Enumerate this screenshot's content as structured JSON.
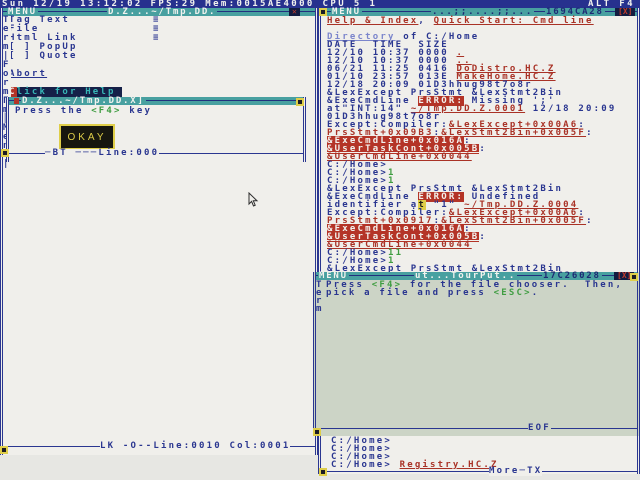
{
  "topbar": {
    "status": "Sun 12/19 13:12:02 FPS:29 Mem:0015AE4000 CPU 5 1",
    "hotkey": "ALT F4"
  },
  "icons": {
    "close_x": "✕",
    "close_box": "[X]",
    "submenu": "≡",
    "red_square": "",
    "resize_handle": ""
  },
  "left_window": {
    "titlebar": {
      "menu_label": "MENU",
      "doc_title": "D.Z...~/Tmp.DD."
    },
    "border_chars": [
      "T",
      "e",
      "r",
      "m",
      "|",
      "F",
      "o",
      "r",
      "m",
      "Г",
      "m",
      "║",
      "M",
      "e",
      "n",
      "u",
      "|"
    ],
    "menu_items": [
      {
        "label": "Tag Text",
        "kind": "submenu"
      },
      {
        "label": "File",
        "kind": "submenu"
      },
      {
        "label": "Html Link",
        "kind": "submenu"
      },
      {
        "label": "[ ] PopUp",
        "kind": "plain"
      },
      {
        "label": "[ ] Quote",
        "kind": "plain"
      },
      {
        "label": "",
        "kind": "blank"
      },
      {
        "label": "Abort",
        "kind": "link"
      },
      {
        "label": "",
        "kind": "blank"
      },
      {
        "label": "Click for Help",
        "kind": "highlight",
        "hotkey": "C"
      }
    ],
    "form_popup": {
      "title": "D.Z...~/Tmp.DD.X]",
      "body": [
        [
          [
            "n",
            "Press the "
          ],
          [
            "g",
            "<F4>"
          ],
          [
            "n",
            " key"
          ]
        ]
      ],
      "button_label": "OKAY",
      "status": "─BT ───Line:000"
    },
    "status": "LK -O--Line:0010 Col:0001"
  },
  "right_window": {
    "titlebar": {
      "menu_label": "MENU",
      "doc_title": "...;;....;;...",
      "address": "1694CA28"
    },
    "lines": [
      [
        [
          "l",
          "Help & Index"
        ],
        [
          "n",
          ", "
        ],
        [
          "l",
          "Quick Start: Cmd line"
        ]
      ],
      [],
      [
        [
          "d",
          "Directory"
        ],
        [
          "n",
          " of C:/Home"
        ]
      ],
      [
        [
          "n",
          "DATE  TIME  SIZE"
        ]
      ],
      [
        [
          "n",
          "12/10 10:37 0000 "
        ],
        [
          "l",
          "."
        ]
      ],
      [
        [
          "n",
          "12/10 10:37 0000 "
        ],
        [
          "l",
          ".."
        ]
      ],
      [
        [
          "n",
          "06/21 11:25 0416 "
        ],
        [
          "l",
          "DoDistro.HC.Z"
        ]
      ],
      [
        [
          "n",
          "01/10 23:57 013E "
        ],
        [
          "l",
          "MakeHome.HC.Z"
        ]
      ],
      [
        [
          "n",
          "12/18 20:09 01D3hhug98t7o8r"
        ]
      ],
      [
        [
          "n",
          "&LexExcept PrsStmt &LexStmt2Bin"
        ]
      ],
      [
        [
          "n",
          "&ExeCmdLine "
        ],
        [
          "e",
          "ERROR:"
        ],
        [
          "n",
          " Missing ';'"
        ]
      ],
      [
        [
          "n",
          "at\"INT:14\" "
        ],
        [
          "l",
          "~/Tmp.DD.Z.0001"
        ],
        [
          "n",
          " 12/18 20:09"
        ]
      ],
      [
        [
          "n",
          "01D3hhug98t7o8r"
        ]
      ],
      [
        [
          "n",
          "Except:Compiler:"
        ],
        [
          "l",
          "&LexExcept+0x00A6"
        ],
        [
          "n",
          ":"
        ]
      ],
      [
        [
          "l",
          "PrsStmt+0x09B3"
        ],
        [
          "n",
          ":"
        ],
        [
          "l",
          "&LexStmt2Bin+0x005F"
        ],
        [
          "n",
          ":"
        ]
      ],
      [
        [
          "i",
          "&ExeCmdLine+0x016A"
        ],
        [
          "n",
          ":"
        ]
      ],
      [
        [
          "i",
          "&UserTaskCont+0x005B"
        ],
        [
          "n",
          ":"
        ]
      ],
      [
        [
          "l",
          "&UserCmdLine+0x0044"
        ]
      ],
      [
        [
          "n",
          "C:/Home>"
        ]
      ],
      [
        [
          "n",
          "C:/Home>"
        ],
        [
          "g",
          "1"
        ]
      ],
      [
        [
          "n",
          "C:/Home>"
        ],
        [
          "g",
          "1"
        ]
      ],
      [
        [
          "n",
          "&LexExcept PrsStmt &LexStmt2Bin"
        ]
      ],
      [
        [
          "n",
          "&ExeCmdLine "
        ],
        [
          "e",
          "ERROR:"
        ],
        [
          "n",
          " Undefined"
        ]
      ],
      [
        [
          "n",
          "identifier a"
        ],
        [
          "c",
          "t"
        ],
        [
          "n",
          " \"1\" "
        ],
        [
          "l",
          "~/Tmp.DD.Z.0004"
        ]
      ],
      [
        [
          "n",
          "Except:Compiler:"
        ],
        [
          "l",
          "&LexExcept+0x00A6"
        ],
        [
          "n",
          ":"
        ]
      ],
      [
        [
          "l",
          "PrsStmt+0x0917"
        ],
        [
          "n",
          ":"
        ],
        [
          "l",
          "&LexStmt2Bin+0x005F"
        ],
        [
          "n",
          ":"
        ]
      ],
      [
        [
          "i",
          "&ExeCmdLine+0x016A"
        ],
        [
          "n",
          ":"
        ]
      ],
      [
        [
          "i",
          "&UserTaskCont+0x005B"
        ],
        [
          "n",
          ":"
        ]
      ],
      [
        [
          "l",
          "&UserCmdLine+0x0044"
        ]
      ],
      [
        [
          "n",
          "C:/Home>"
        ],
        [
          "g",
          "11"
        ]
      ],
      [
        [
          "n",
          "C:/Home>"
        ],
        [
          "g",
          "1"
        ]
      ],
      [
        [
          "n",
          "&LexExcept PrsStmt &LexStmt2Bin"
        ]
      ]
    ],
    "footer_lines": [
      [
        [
          "n",
          "C:/Home>"
        ]
      ],
      [
        [
          "n",
          "C:/Home>"
        ]
      ],
      [
        [
          "n",
          "C:/Home>"
        ]
      ],
      [
        [
          "n",
          "C:/Home> "
        ],
        [
          "l",
          "Registry.HC.Z"
        ]
      ]
    ],
    "status": "More─TX"
  },
  "overlay_popup": {
    "titlebar": {
      "menu_label": "MENU",
      "doc_title": "ut...TourPut..",
      "address": "17C26028"
    },
    "border_chars": [
      "T",
      "e",
      "r",
      "m"
    ],
    "body": [
      [
        [
          "n",
          "Press "
        ],
        [
          "g",
          "<F4>"
        ],
        [
          "n",
          " for the file chooser.  Then,"
        ]
      ],
      [
        [
          "n",
          "pick a file and press "
        ],
        [
          "g",
          "<ESC>"
        ],
        [
          "n",
          "."
        ]
      ]
    ],
    "eof_label": "EOF"
  }
}
